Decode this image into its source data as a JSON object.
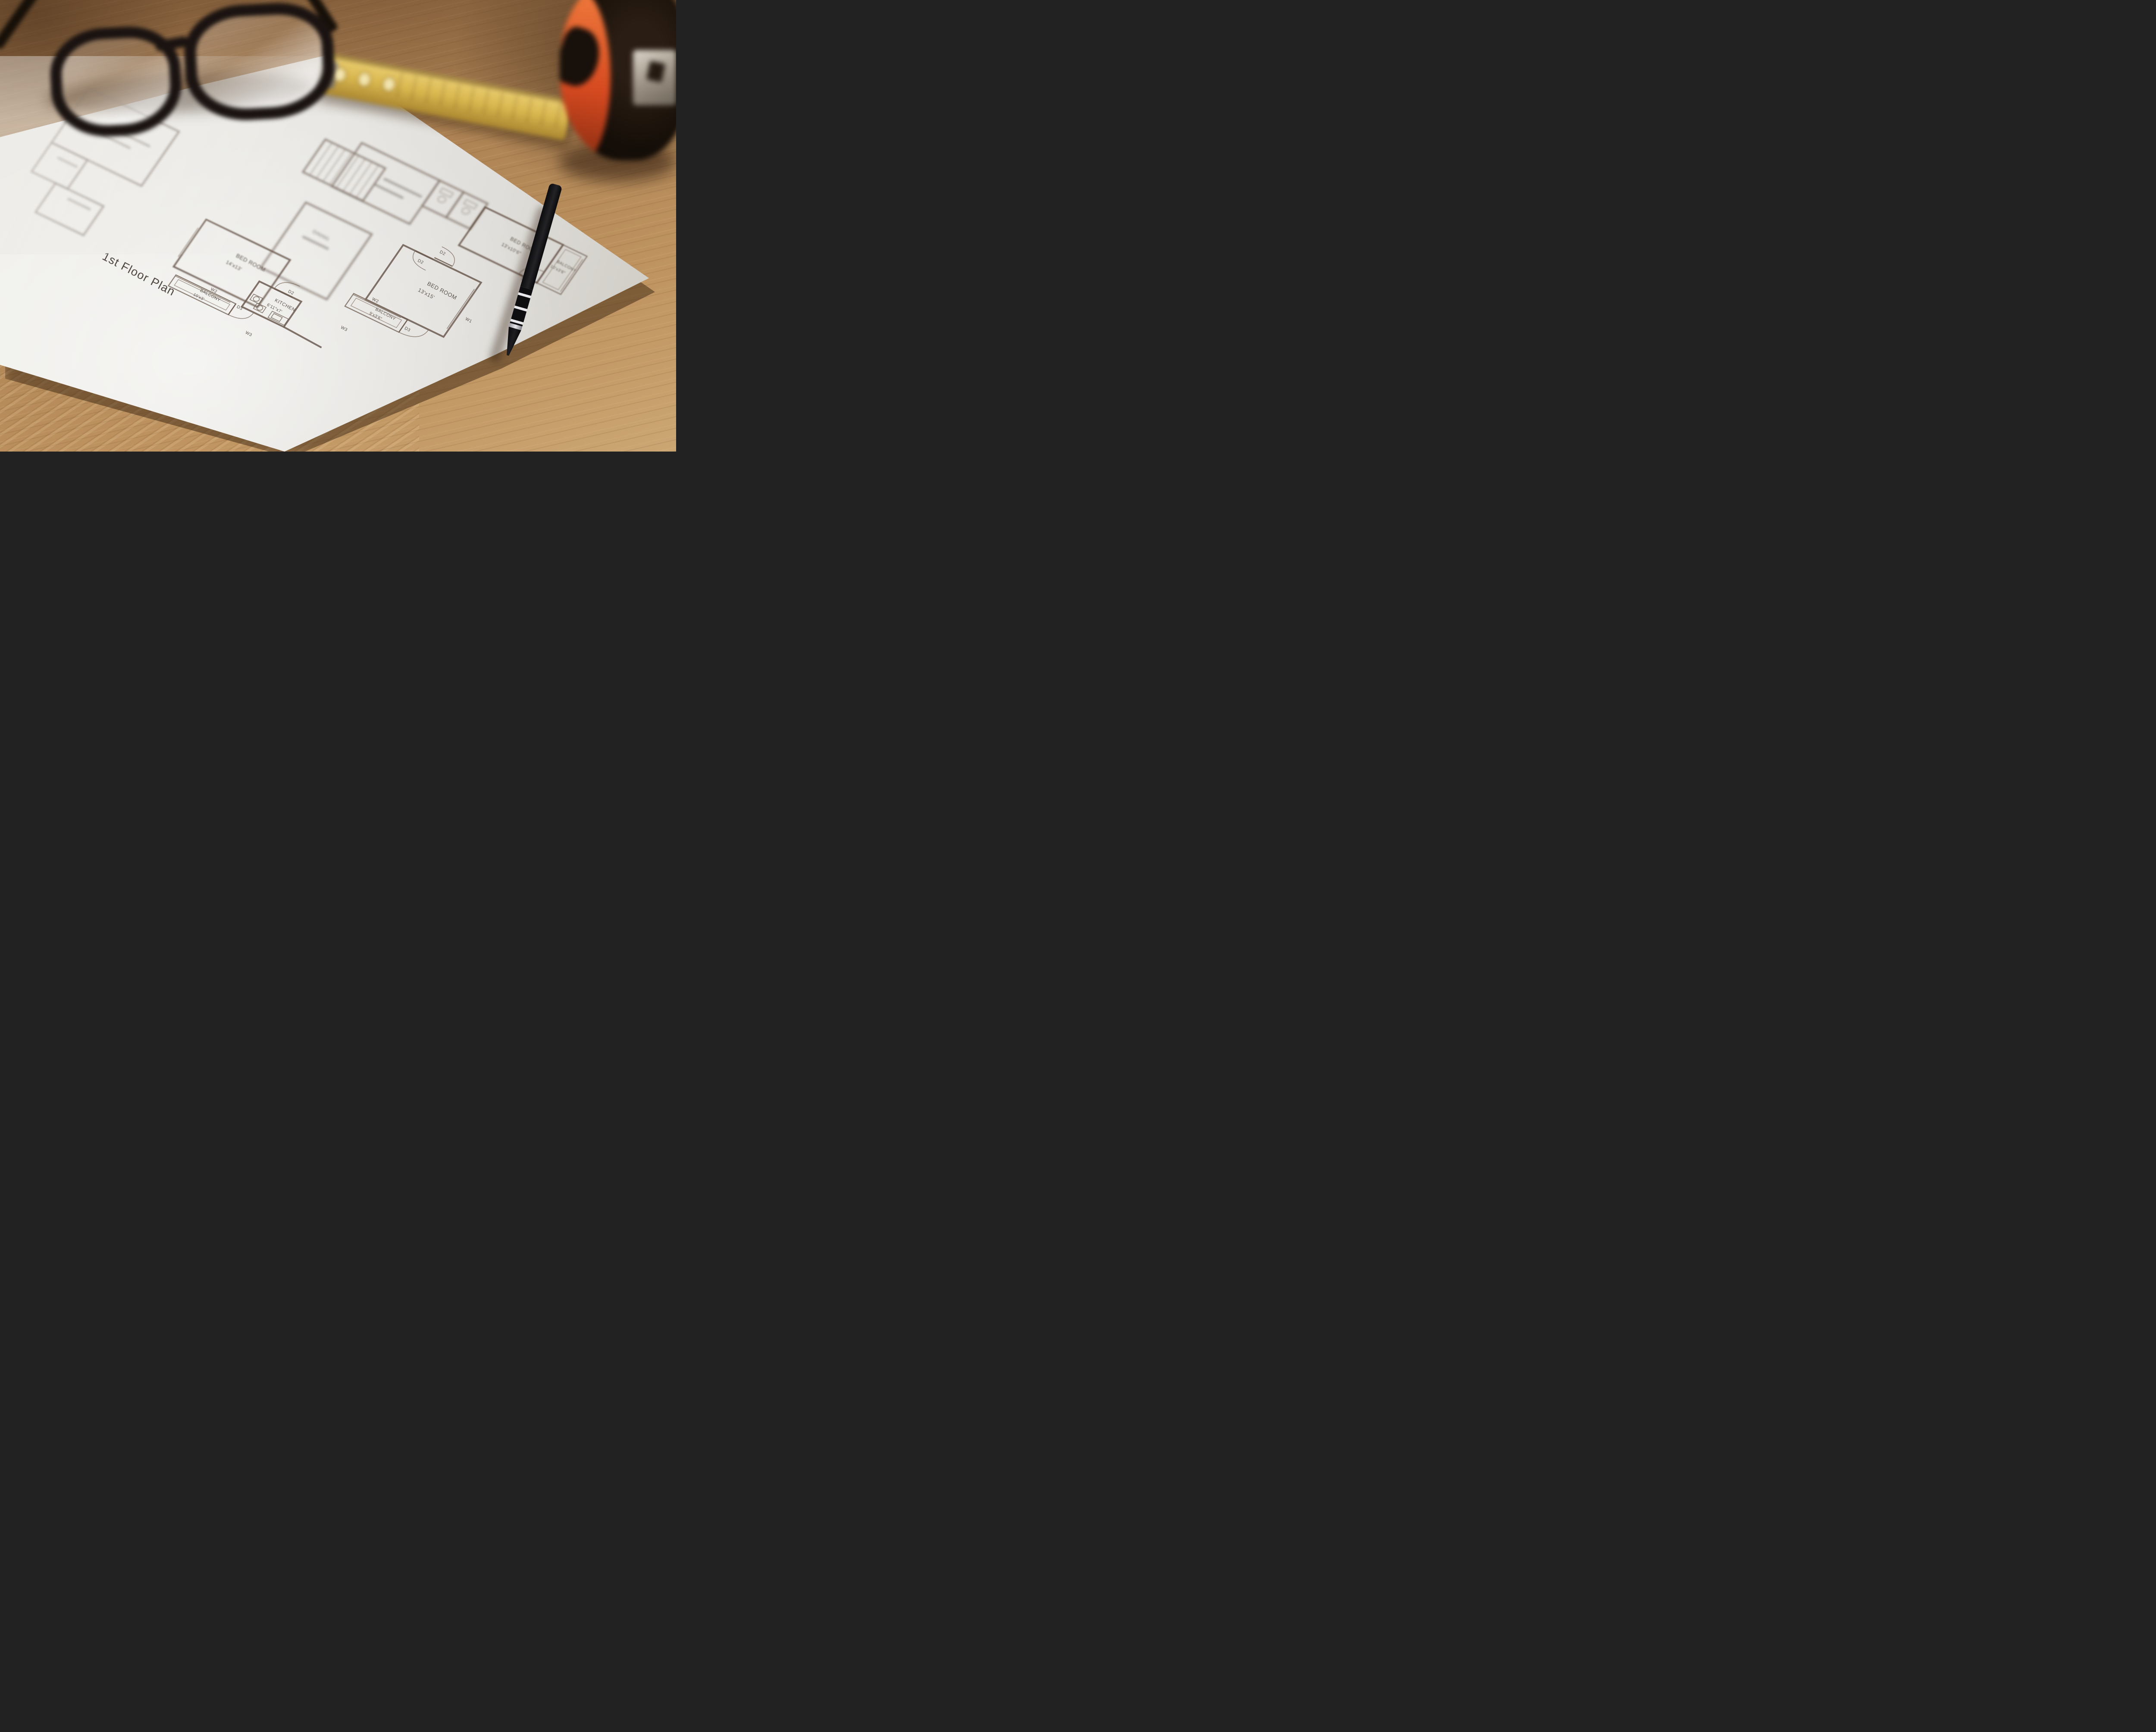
{
  "scene_objects": {
    "paper": {
      "kind": "floor plan blueprint sheet",
      "color": "#e9e7e3"
    },
    "glasses": {
      "kind": "eyeglasses",
      "frame_color": "#1a1311"
    },
    "folding_ruler": {
      "kind": "yellow folding ruler",
      "color": "#d9b954"
    },
    "tape_measure": {
      "kind": "tape measure",
      "body_color": "#16100b",
      "accent_color": "#d14a26",
      "clip_color": "#a99f94"
    },
    "pen": {
      "kind": "black pen",
      "body_color": "#17171a",
      "ring_color": "#e6e6e9"
    },
    "desk": {
      "kind": "wooden desk",
      "color": "#b28757"
    }
  },
  "floor_plan": {
    "title": "1st Floor Plan",
    "rooms": [
      {
        "name": "BED ROOM",
        "dimensions": "14'x13'"
      },
      {
        "name": "KITCHEN",
        "dimensions": "6'11\"x7'"
      },
      {
        "name": "BALCONY",
        "dimensions": "10'x3'"
      },
      {
        "name": "DINING",
        "dimensions": ""
      },
      {
        "name": "BED ROOM",
        "dimensions": "13'x15'"
      },
      {
        "name": "BALCONY",
        "dimensions": "9'x3'6\""
      },
      {
        "name": "BED ROOM",
        "dimensions": "13'x10'6\""
      },
      {
        "name": "BALCONY",
        "dimensions": "10'x3'6\""
      }
    ],
    "markers": [
      "W1",
      "W2",
      "W3",
      "D2",
      "D3"
    ]
  },
  "plan_render": {
    "rooms": [
      {
        "id": "bedroom-far-left",
        "wing": "left",
        "rect": [
          -24,
          6,
          15,
          15
        ],
        "blur": 2
      },
      {
        "id": "toilet-far-left",
        "wing": "left",
        "rect": [
          -24,
          21,
          6,
          8
        ],
        "blur": 2
      },
      {
        "id": "store-far-left",
        "wing": "left",
        "rect": [
          -20,
          29,
          8,
          8
        ],
        "blur": 2
      },
      {
        "id": "stairs",
        "wing": "left",
        "rect": [
          10,
          -7,
          10,
          9
        ],
        "blur": 2,
        "type": "stairs",
        "steps": 9
      },
      {
        "id": "dining",
        "wing": "left",
        "rect": [
          13,
          8,
          11,
          18
        ],
        "blur": 2
      },
      {
        "id": "bedroom-14x13",
        "wing": "left",
        "rect": [
          2,
          21.5,
          14,
          13
        ],
        "blur": 1
      },
      {
        "id": "kitchen",
        "wing": "left",
        "rect": [
          14,
          29,
          7,
          7
        ],
        "blur": 0
      },
      {
        "id": "balcony-10x3",
        "wing": "left",
        "rect": [
          3,
          36,
          10,
          3
        ],
        "blur": 0,
        "type": "balcony"
      },
      {
        "id": "living-room",
        "wing": "right",
        "rect": [
          -14,
          -17,
          13,
          12
        ],
        "blur": 2
      },
      {
        "id": "toilet-1",
        "wing": "right",
        "rect": [
          -1,
          -17,
          4,
          7
        ],
        "blur": 2
      },
      {
        "id": "toilet-2",
        "wing": "right",
        "rect": [
          3,
          -17,
          4,
          7
        ],
        "blur": 2
      },
      {
        "id": "bedroom-13x10",
        "wing": "right",
        "rect": [
          7,
          -16,
          13,
          10.5
        ],
        "blur": 1
      },
      {
        "id": "balcony-right",
        "wing": "right",
        "rect": [
          20,
          -16,
          4,
          10.5
        ],
        "blur": 1,
        "type": "balcony"
      },
      {
        "id": "bedroom-13x15",
        "wing": "right",
        "rect": [
          0,
          0,
          13,
          15
        ],
        "blur": 0
      },
      {
        "id": "balcony-9x3",
        "wing": "right",
        "rect": [
          -2,
          15,
          9,
          3.5
        ],
        "blur": 0,
        "type": "balcony"
      }
    ],
    "texts": [
      {
        "t": "1st Floor Plan",
        "wing": "left",
        "x": -7.7,
        "y": 40.1,
        "s": 27,
        "k": "ttl",
        "f": 0
      },
      {
        "t": "BED ROOM",
        "wing": "left",
        "x": 8.9,
        "y": 26.3,
        "s": 13,
        "f": 1
      },
      {
        "t": "14'x13'",
        "wing": "left",
        "x": 8.2,
        "y": 28.6,
        "s": 11.5,
        "f": 1
      },
      {
        "t": "BALCONY",
        "wing": "left",
        "x": 7.4,
        "y": 37.0,
        "s": 10,
        "f": 0
      },
      {
        "t": "10'x3'",
        "wing": "left",
        "x": 6.9,
        "y": 38.5,
        "s": 9.5,
        "f": 0
      },
      {
        "t": "KITCHEN",
        "wing": "left",
        "x": 17.6,
        "y": 31.6,
        "s": 11,
        "f": 0
      },
      {
        "t": "6'11\"x7'",
        "wing": "left",
        "x": 17.0,
        "y": 33.3,
        "s": 10,
        "f": 0
      },
      {
        "t": "DINING",
        "wing": "left",
        "x": 16.4,
        "y": 13.6,
        "s": 11,
        "f": 2
      },
      {
        "t": "W2",
        "wing": "left",
        "x": 8.6,
        "y": 35.7,
        "s": 10,
        "f": 0
      },
      {
        "t": "D3",
        "wing": "left",
        "x": 13.4,
        "y": 36.7,
        "s": 10,
        "f": 0
      },
      {
        "t": "W3",
        "wing": "left",
        "x": 16.7,
        "y": 41.2,
        "s": 10,
        "f": 0
      },
      {
        "t": "D2",
        "wing": "left",
        "x": 18.5,
        "y": 28.4,
        "s": 10,
        "f": 0
      },
      {
        "t": "W3",
        "wing": "left",
        "x": 28.2,
        "y": 30.6,
        "s": 10,
        "f": 0
      },
      {
        "t": "BED ROOM",
        "wing": "right",
        "x": 6.4,
        "y": 5.9,
        "s": 13,
        "f": 0
      },
      {
        "t": "13'x15'",
        "wing": "right",
        "x": 5.8,
        "y": 8.1,
        "s": 12,
        "f": 0
      },
      {
        "t": "BALCONY",
        "wing": "right",
        "x": 2.1,
        "y": 16.3,
        "s": 10,
        "f": 0
      },
      {
        "t": "9'x3'6\"",
        "wing": "right",
        "x": 1.7,
        "y": 17.7,
        "s": 9.5,
        "f": 0
      },
      {
        "t": "BED ROOM",
        "wing": "right",
        "x": 12.9,
        "y": -11.7,
        "s": 12,
        "f": 1
      },
      {
        "t": "13'x10'6\"",
        "wing": "right",
        "x": 12.3,
        "y": -9.7,
        "s": 11,
        "f": 1
      },
      {
        "t": "BALCONY",
        "wing": "right",
        "x": 20.7,
        "y": -11.7,
        "s": 9.5,
        "f": 1
      },
      {
        "t": "10'x3'6\"",
        "wing": "right",
        "x": 20.3,
        "y": -10.1,
        "s": 9.5,
        "f": 1
      },
      {
        "t": "W1",
        "wing": "right",
        "x": 14.2,
        "y": 9.3,
        "s": 10,
        "f": 0
      },
      {
        "t": "W2",
        "wing": "right",
        "x": 0.8,
        "y": 14.5,
        "s": 10,
        "f": 0
      },
      {
        "t": "D3",
        "wing": "right",
        "x": 7.4,
        "y": 17.3,
        "s": 10,
        "f": 0
      },
      {
        "t": "D2",
        "wing": "right",
        "x": 5.2,
        "y": -2.0,
        "s": 10,
        "f": 0
      },
      {
        "t": "D2",
        "wing": "right",
        "x": 3.2,
        "y": 2.0,
        "s": 10,
        "f": 0
      },
      {
        "t": "D3",
        "wing": "right",
        "x": 17.7,
        "y": -4.6,
        "s": 10,
        "f": 1
      }
    ],
    "doors": [
      {
        "wing": "left",
        "pivot": [
          19.5,
          29
        ],
        "tip": [
          16.5,
          29
        ],
        "end": [
          19.5,
          26
        ],
        "f": 0
      },
      {
        "wing": "left",
        "pivot": [
          13,
          36
        ],
        "tip": [
          13,
          39
        ],
        "end": [
          16,
          36
        ],
        "f": 0
      },
      {
        "wing": "right",
        "pivot": [
          5,
          0
        ],
        "tip": [
          2,
          0
        ],
        "end": [
          5,
          3
        ],
        "f": 0
      },
      {
        "wing": "right",
        "pivot": [
          5,
          -0.5
        ],
        "tip": [
          8,
          -0.5
        ],
        "end": [
          5,
          -3.5
        ],
        "f": 0
      },
      {
        "wing": "right",
        "pivot": [
          7,
          15
        ],
        "tip": [
          7,
          18.5
        ],
        "end": [
          10.5,
          15
        ],
        "f": 0
      },
      {
        "wing": "right",
        "pivot": [
          20,
          -5.5
        ],
        "tip": [
          17,
          -5.5
        ],
        "end": [
          20,
          -8.5
        ],
        "f": 1
      }
    ],
    "windows": [
      {
        "wing": "left",
        "p1": [
          3,
          36
        ],
        "p2": [
          12.2,
          36
        ],
        "f": 0
      },
      {
        "wing": "right",
        "p1": [
          13,
          2
        ],
        "p2": [
          13,
          13
        ],
        "f": 0
      },
      {
        "wing": "right",
        "p1": [
          -2,
          15
        ],
        "p2": [
          6,
          15
        ],
        "f": 0
      },
      {
        "wing": "right",
        "p1": [
          24,
          -15
        ],
        "p2": [
          24,
          -6
        ],
        "f": 1
      },
      {
        "wing": "left",
        "p1": [
          2,
          24
        ],
        "p2": [
          2,
          32
        ],
        "f": 1
      }
    ],
    "walls": [
      {
        "wing": "left",
        "p1": [
          21,
          36
        ],
        "p2": [
          27.5,
          36.5
        ],
        "f": 0
      }
    ],
    "smudges": [
      {
        "wing": "left",
        "x": -17.5,
        "y": 12,
        "len": 6,
        "f": 2
      },
      {
        "wing": "left",
        "x": -18.3,
        "y": 14.3,
        "len": 4.5,
        "f": 2
      },
      {
        "wing": "left",
        "x": -21.8,
        "y": 23.5,
        "len": 3,
        "f": 2
      },
      {
        "wing": "left",
        "x": -17,
        "y": 31,
        "len": 3.5,
        "f": 2
      },
      {
        "wing": "left",
        "x": 15.7,
        "y": 15.4,
        "len": 4,
        "f": 2
      },
      {
        "wing": "right",
        "x": -8,
        "y": -11.8,
        "len": 6,
        "f": 2
      },
      {
        "wing": "right",
        "x": -8.7,
        "y": -9.7,
        "len": 4.5,
        "f": 2
      }
    ],
    "fixtures": [
      {
        "type": "stove",
        "wing": "left",
        "x": 14.4,
        "y": 32.2,
        "f": 0
      },
      {
        "type": "stove",
        "wing": "left",
        "x": 15.6,
        "y": 33.7,
        "f": 0
      },
      {
        "type": "sink",
        "wing": "left",
        "x": 18.2,
        "y": 33.9,
        "f": 0
      },
      {
        "type": "wc",
        "wing": "right",
        "x": 0.9,
        "y": -13.3,
        "f": 2
      },
      {
        "type": "wc",
        "wing": "right",
        "x": 4.9,
        "y": -13.3,
        "f": 2
      }
    ]
  }
}
